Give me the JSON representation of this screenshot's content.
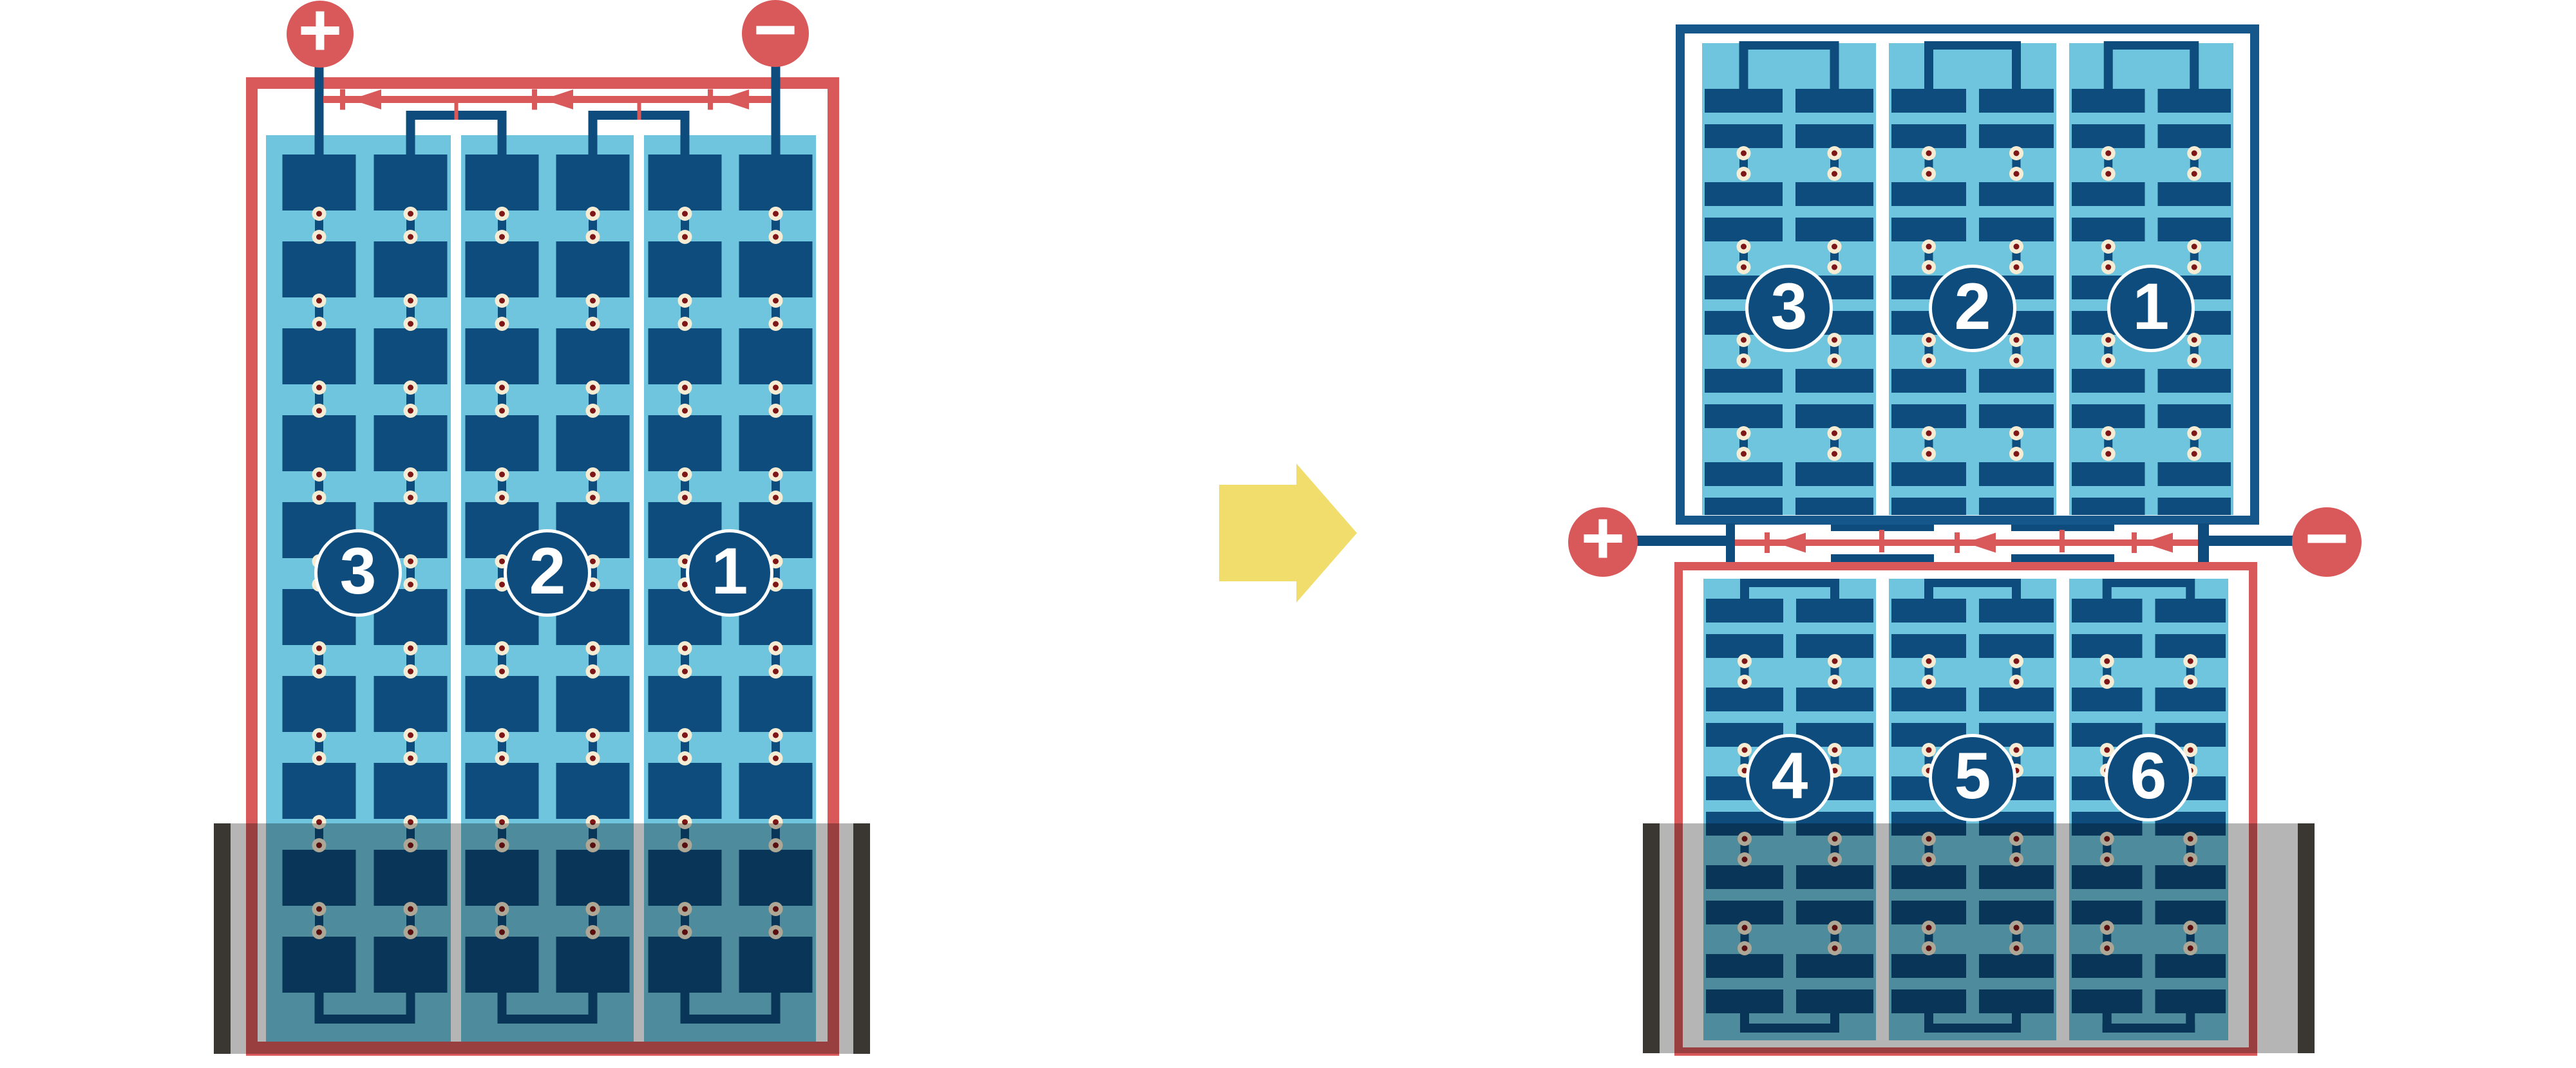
{
  "colors": {
    "background": "#FFFFFF",
    "red": "#D9595A",
    "plate_blue": "#0D4C7C",
    "frame_blue": "#16578B",
    "light_blue": "#6FC5DD",
    "cream": "#F6ECD4",
    "dot_red": "#7E1517",
    "shade_bar": "#3A3733",
    "shade_overlay": "rgba(0,0,0,0.29)",
    "arrow_yellow": "#F1DD6C",
    "label_text": "#FFFFFF"
  },
  "left_module": {
    "frame_color_key": "red",
    "terminals": [
      {
        "polarity": "positive",
        "glyph": "+"
      },
      {
        "polarity": "negative",
        "glyph": "−"
      }
    ],
    "strings": [
      {
        "label": "3"
      },
      {
        "label": "2"
      },
      {
        "label": "1"
      }
    ],
    "bypass_diode_count": 3,
    "shaded_bottom": true
  },
  "transform_arrow": {
    "direction": "right"
  },
  "right_modules": {
    "top_module": {
      "frame_color_key": "frame_blue",
      "strings": [
        {
          "label": "3"
        },
        {
          "label": "2"
        },
        {
          "label": "1"
        }
      ],
      "shaded_bottom": false
    },
    "bottom_module": {
      "frame_color_key": "red",
      "strings": [
        {
          "label": "4"
        },
        {
          "label": "5"
        },
        {
          "label": "6"
        }
      ],
      "shaded_bottom": true
    },
    "terminals": [
      {
        "polarity": "positive",
        "glyph": "+"
      },
      {
        "polarity": "negative",
        "glyph": "−"
      }
    ],
    "bypass_diode_count": 3
  }
}
